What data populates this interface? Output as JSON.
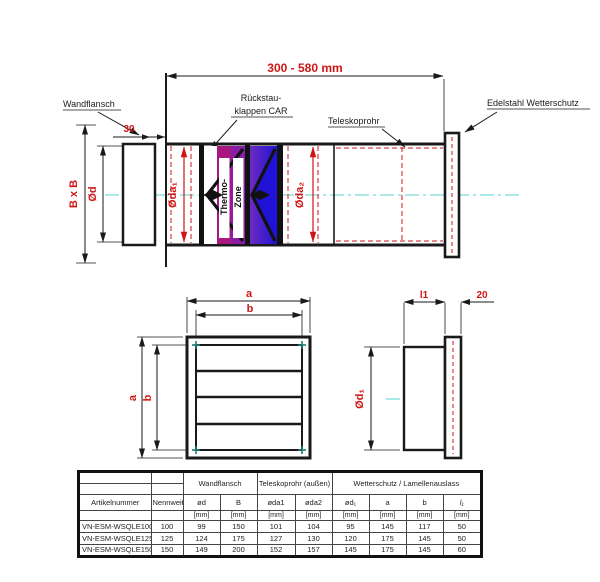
{
  "colors": {
    "dim_red": "#d01515",
    "centerline_cyan": "#8fe0e0",
    "flap_magenta": "#a8187e",
    "flap_purple": "#8a1ca8",
    "flap_violet": "#6b2bc0",
    "flap_blue": "#2013d6",
    "corner_teal": "#1f7d72"
  },
  "top_view": {
    "range_dim": "300 - 580 mm",
    "label_wandflansch": "Wandflansch",
    "label_rueckstau_1": "Rückstau-",
    "label_rueckstau_2": "klappen CAR",
    "label_teleskoprohr": "Teleskoprohr",
    "label_wetterschutz": "Edelstahl Wetterschutz",
    "dim_30": "30",
    "dim_bxb": "B x B",
    "dim_od": "Ød",
    "dim_oda1": "Øda₁",
    "dim_oda2": "Øda₂",
    "thermo_line1": "Thermo-",
    "thermo_line2": "Zone"
  },
  "front_view": {
    "dim_a_top": "a",
    "dim_b_top": "b",
    "dim_a_left": "a",
    "dim_b_left": "b"
  },
  "side_view": {
    "dim_l1": "l1",
    "dim_20": "20",
    "dim_od1": "Ød₁"
  },
  "table": {
    "group_headers": [
      "Wandflansch",
      "Teleskoprohr (außen)",
      "Wetterschutz / Lamellenauslass"
    ],
    "columns": [
      "Artikelnummer",
      "Nennweite",
      "ød",
      "B",
      "øda1",
      "øda2",
      "ød₁",
      "a",
      "b",
      "l₁"
    ],
    "units": "[mm]",
    "rows": [
      [
        "VN-ESM-WSQLE100",
        "100",
        "99",
        "150",
        "101",
        "104",
        "95",
        "145",
        "117",
        "50"
      ],
      [
        "VN-ESM-WSQLE125",
        "125",
        "124",
        "175",
        "127",
        "130",
        "120",
        "175",
        "145",
        "50"
      ],
      [
        "VN-ESM-WSQLE150",
        "150",
        "149",
        "200",
        "152",
        "157",
        "145",
        "175",
        "145",
        "60"
      ]
    ]
  }
}
